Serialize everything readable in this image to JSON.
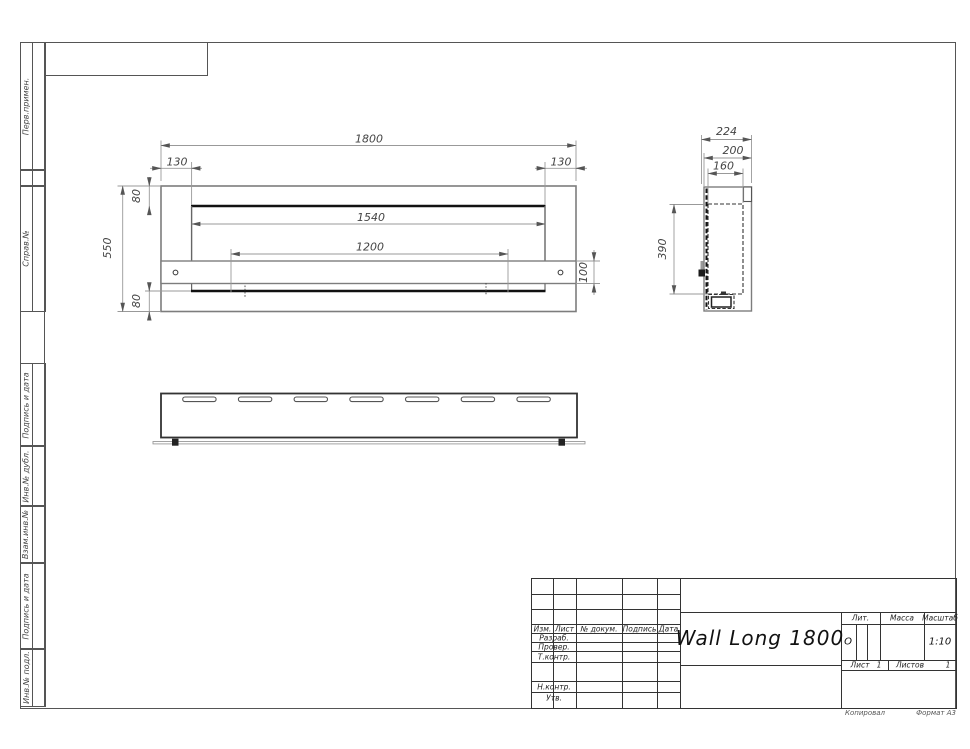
{
  "sheet": {
    "copied_label": "Копировал",
    "format_label": "Формат А3"
  },
  "margin_labels": [
    "Перв.примен.",
    "Справ.№",
    "Подпись и дата",
    "Инв.№ дубл.",
    "Взам.инв.№",
    "Подпись и дата",
    "Инв.№ подл."
  ],
  "title_block": {
    "product_name": "Wall Long 1800",
    "header_cols": [
      "Изм.",
      "Лист",
      "№ докум.",
      "Подпись",
      "Дата"
    ],
    "role_rows": [
      "Разраб.",
      "Провер.",
      "Т.контр.",
      "Н.контр.",
      "Утв."
    ],
    "lit_label": "Лит.",
    "lit_value": "О",
    "mass_label": "Масса",
    "scale_label": "Масштаб",
    "scale_value": "1:10",
    "sheet_label": "Лист",
    "sheet_value": "1",
    "sheets_label": "Листов",
    "sheets_value": "1"
  },
  "dimensions": {
    "front": {
      "total_width": "1800",
      "inner_width": "1540",
      "hole_span": "1200",
      "total_height": "550",
      "margin_left": "130",
      "margin_right": "130",
      "top_margin": "80",
      "bottom_margin": "80",
      "band_height": "100"
    },
    "side": {
      "total_depth": "224",
      "body_depth": "200",
      "inner_depth": "160",
      "opening_height": "390"
    }
  }
}
